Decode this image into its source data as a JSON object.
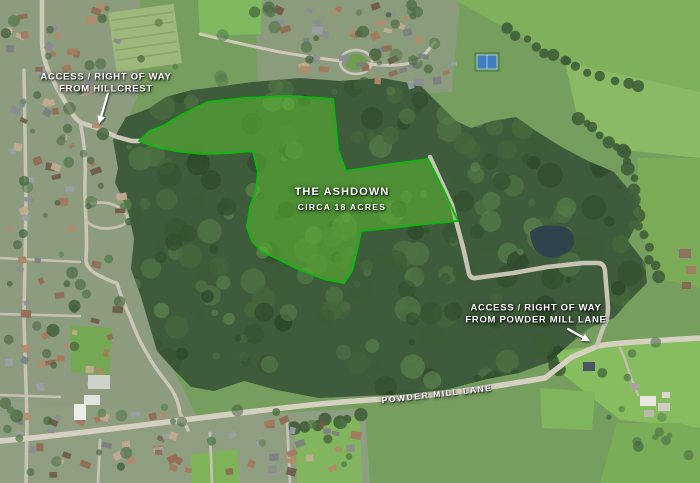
{
  "property": {
    "name": "THE ASHDOWN",
    "area": "CIRCA 18 ACRES"
  },
  "annotations": {
    "hillcrest": {
      "line1": "ACCESS / RIGHT OF WAY",
      "line2": "FROM HILLCREST"
    },
    "powder_mill": {
      "line1": "ACCESS / RIGHT OF WAY",
      "line2": "FROM POWDER MILL LANE"
    },
    "road": {
      "name": "POWDER MILL LANE"
    }
  },
  "colors": {
    "boundary_stroke": "#12b412",
    "boundary_fill": "rgba(95,195,50,0.5)",
    "label_text": "#ffffff"
  }
}
